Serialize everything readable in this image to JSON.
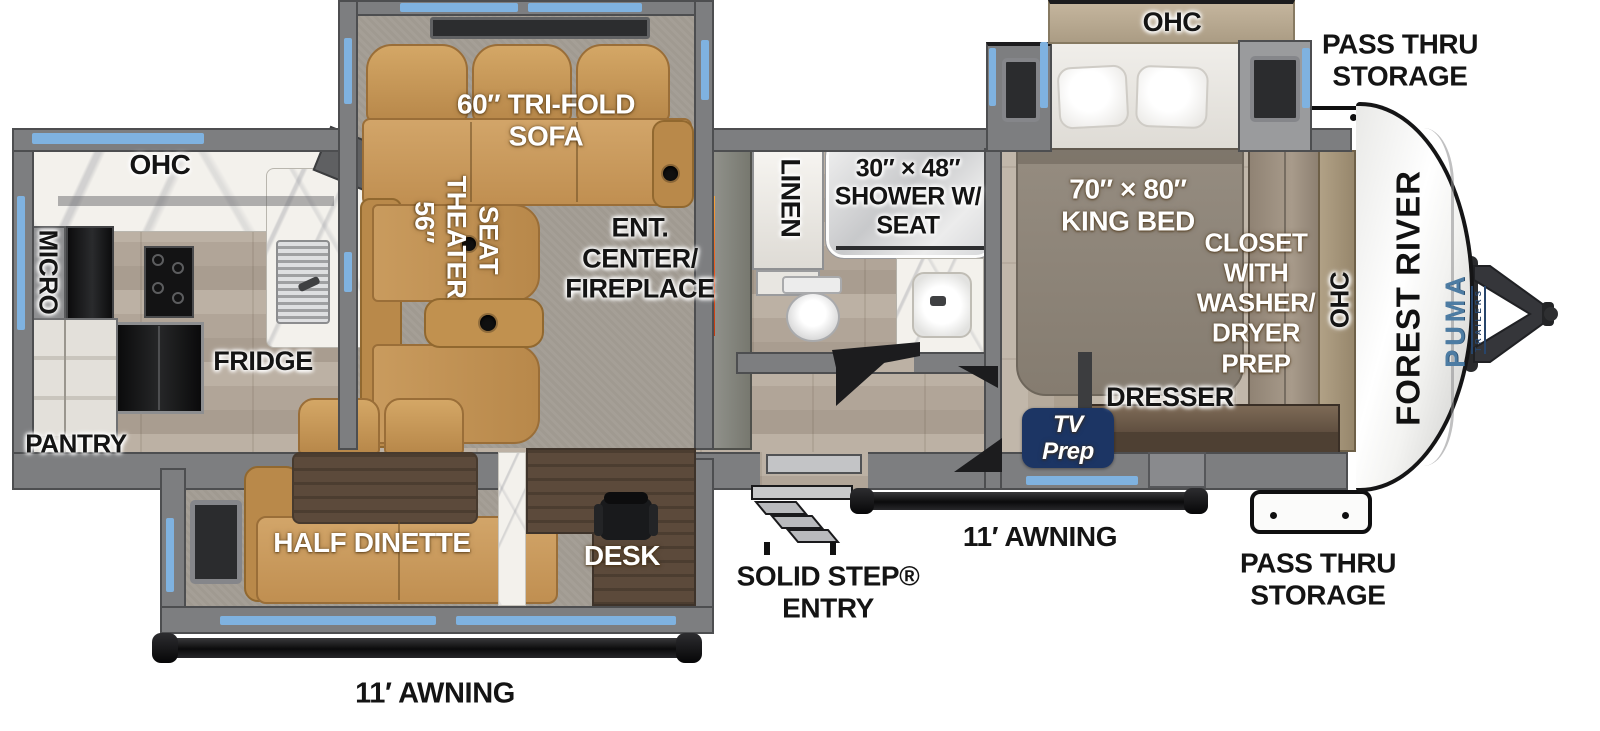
{
  "title": "Travel trailer floor plan",
  "labels": {
    "ohc_kitchen": "OHC",
    "micro": "MICRO",
    "fridge": "FRIDGE",
    "pantry": "PANTRY",
    "tri_fold_sofa": "60″ TRI-FOLD\nSOFA",
    "theater_seat_size": "56″",
    "theater_seat_word1": "THEATER",
    "theater_seat_word2": "SEAT",
    "ent_center": "ENT.\nCENTER/\nFIREPLACE",
    "linen": "LINEN",
    "shower": "30″ × 48″\nSHOWER W/\nSEAT",
    "king_bed": "70″ × 80″\nKING BED",
    "ohc_bed_slide": "OHC",
    "closet": "CLOSET\nWITH\nWASHER/\nDRYER\nPREP",
    "dresser": "DRESSER",
    "tv_prep": "TV\nPrep",
    "ohc_front": "OHC",
    "pass_thru_top": "PASS THRU\nSTORAGE",
    "pass_thru_bottom": "PASS THRU\nSTORAGE",
    "half_dinette": "HALF DINETTE",
    "desk": "DESK",
    "solid_step_entry": "SOLID STEP®\nENTRY",
    "awning_left": "11′ AWNING",
    "awning_right": "11′ AWNING"
  },
  "branding": {
    "manufacturer": "FOREST RIVER",
    "model": "PUMA",
    "model_sub": "TRAILERS"
  },
  "colors": {
    "accent_blue": "#7fb2e0",
    "sofa_tan": "#cb9d60",
    "tv_prep_navy": "#1c3564",
    "puma_blue": "#4d7ca3",
    "fireplace_orange": "#e8541d",
    "wall_gray": "#7d7e80",
    "awning_black": "#141415"
  }
}
